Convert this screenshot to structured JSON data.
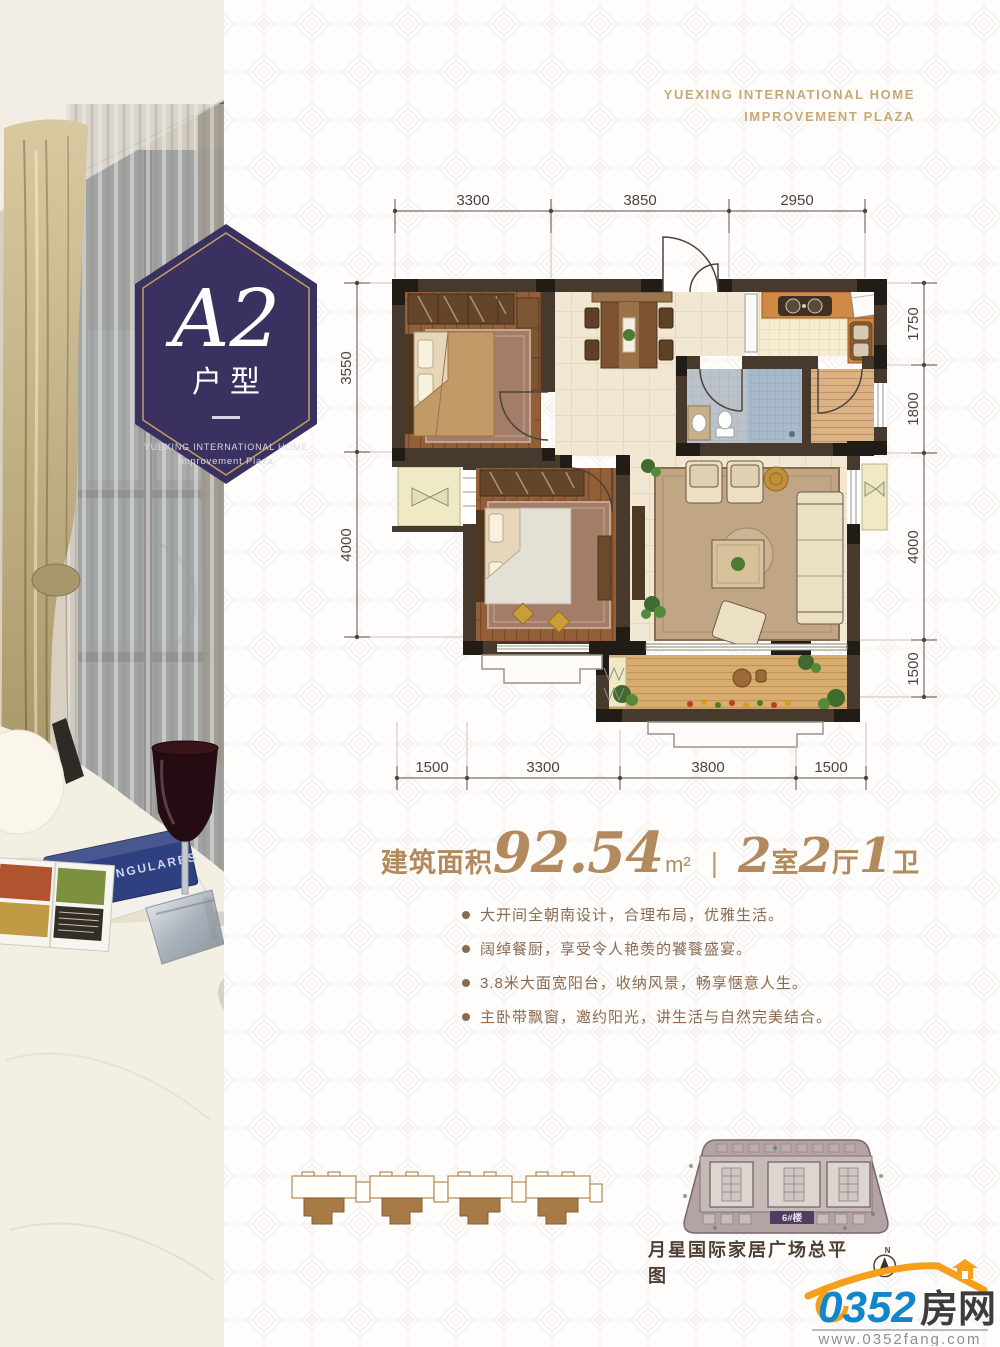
{
  "brand": {
    "line1": "YUEXING INTERNATIONAL HOME",
    "line2": "IMPROVEMENT PLAZA"
  },
  "badge": {
    "unit": "A2",
    "unit_label": "户型",
    "sub_line1": "YUEXING INTERNATIONAL HOME",
    "sub_line2": "Improvement Plaza"
  },
  "plan": {
    "dims_top": [
      "3300",
      "3850",
      "2950"
    ],
    "dims_left": [
      "3550",
      "4000"
    ],
    "dims_right": [
      "1750",
      "1800",
      "4000",
      "1500"
    ],
    "dims_bottom": [
      "1500",
      "3300",
      "3800",
      "1500"
    ]
  },
  "summary": {
    "area_label": "建筑面积",
    "area_value": "92.54",
    "area_unit": "m²",
    "divider": "|",
    "room_1_num": "2",
    "room_1_label": "室",
    "room_2_num": "2",
    "room_2_label": "厅",
    "room_3_num": "1",
    "room_3_label": "卫"
  },
  "features": [
    "大开间全朝南设计，合理布局，优雅生活。",
    "阔绰餐厨，享受令人艳羡的饕餮盛宴。",
    "3.8米大面宽阳台，收纳风景，畅享惬意人生。",
    "主卧带飘窗，邀约阳光，讲生活与自然完美结合。"
  ],
  "siteplan": {
    "building_label": "6#楼",
    "caption": "月星国际家居广场总平图",
    "compass_label": "N"
  },
  "photo": {
    "book_title": "CASAS SINGULARES",
    "watermark": "Yue"
  },
  "logo": {
    "number": "0352",
    "cn": "房网",
    "url": "www.0352fang.com"
  },
  "colors": {
    "badge_purple": "#3b3161",
    "gold": "#c3a060",
    "tan_text": "#c9a877",
    "summary_tan": "#b28a5e",
    "feature_brown": "#8a6a52",
    "logo_blue": "#1187c9",
    "logo_orange": "#f59f1a"
  }
}
